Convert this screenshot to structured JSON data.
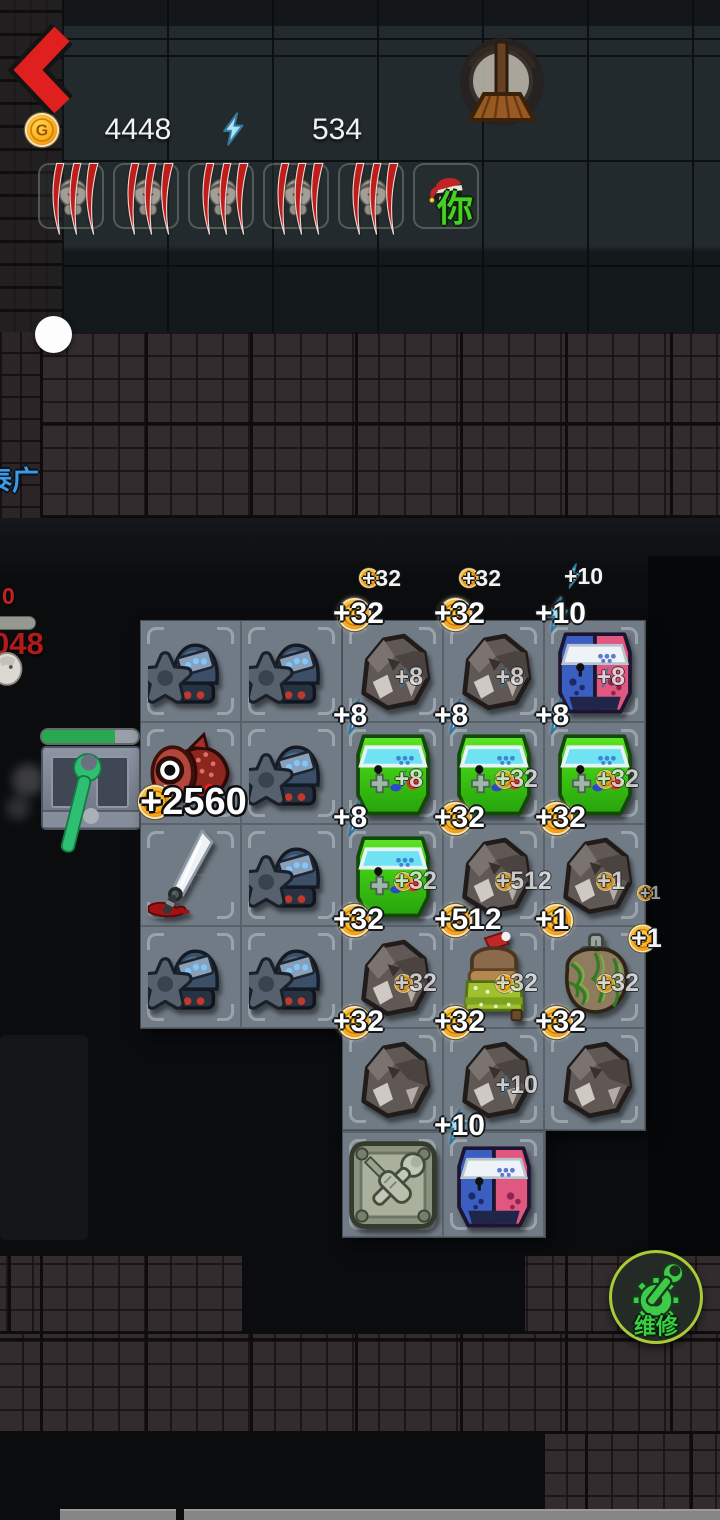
{
  "topbar": {
    "gold": "4448",
    "energy": "534"
  },
  "squad": {
    "you_label": "你",
    "slots": [
      {
        "state": "dead"
      },
      {
        "state": "dead"
      },
      {
        "state": "dead"
      },
      {
        "state": "dead"
      },
      {
        "state": "dead"
      },
      {
        "state": "you",
        "label": "你"
      }
    ]
  },
  "hud": {
    "player_name": "泰广",
    "dmg_small": "0",
    "dmg_big": "048"
  },
  "repair_station": {
    "progress": 0.76
  },
  "repair_button": {
    "label": "维修"
  },
  "icons": {
    "coin_letter": "G"
  },
  "popups": {
    "big_reward": {
      "icon": "coin",
      "text": "+2560"
    },
    "above_grid": [
      {
        "icon": "coin",
        "text": "+32"
      },
      {
        "icon": "coin",
        "text": "+32"
      },
      {
        "icon": "bolt",
        "text": "+10"
      }
    ],
    "side": [
      {
        "icon": "coin",
        "text": "+1",
        "size": "small"
      },
      {
        "icon": "coin",
        "text": "+1",
        "size": "large"
      }
    ]
  },
  "grid": {
    "cells": [
      {
        "r": 1,
        "c": 1,
        "item": "turret"
      },
      {
        "r": 1,
        "c": 2,
        "item": "turret"
      },
      {
        "r": 1,
        "c": 3,
        "item": "rock",
        "badge": {
          "icon": "coin",
          "text": "+32"
        },
        "sub": {
          "icon": "bolt",
          "text": "+8"
        }
      },
      {
        "r": 1,
        "c": 4,
        "item": "rock",
        "badge": {
          "icon": "coin",
          "text": "+32"
        },
        "sub": {
          "icon": "bolt",
          "text": "+8"
        }
      },
      {
        "r": 1,
        "c": 5,
        "item": "arcadePink",
        "badge": {
          "icon": "bolt",
          "text": "+10"
        },
        "sub": {
          "icon": "bolt",
          "text": "+8"
        }
      },
      {
        "r": 2,
        "c": 1,
        "item": "redfish"
      },
      {
        "r": 2,
        "c": 2,
        "item": "turret"
      },
      {
        "r": 2,
        "c": 3,
        "item": "arcadeGreen",
        "badge": {
          "icon": "bolt",
          "text": "+8"
        },
        "sub": {
          "icon": "bolt",
          "text": "+8"
        }
      },
      {
        "r": 2,
        "c": 4,
        "item": "arcadeGreen",
        "badge": {
          "icon": "bolt",
          "text": "+8"
        },
        "sub": {
          "icon": "coin",
          "text": "+32"
        }
      },
      {
        "r": 2,
        "c": 5,
        "item": "arcadeGreen",
        "badge": {
          "icon": "bolt",
          "text": "+8"
        },
        "sub": {
          "icon": "coin",
          "text": "+32"
        }
      },
      {
        "r": 3,
        "c": 1,
        "item": "knife"
      },
      {
        "r": 3,
        "c": 2,
        "item": "turret"
      },
      {
        "r": 3,
        "c": 3,
        "item": "arcadeGreen",
        "badge": {
          "icon": "bolt",
          "text": "+8"
        },
        "sub": {
          "icon": "coin",
          "text": "+32"
        }
      },
      {
        "r": 3,
        "c": 4,
        "item": "rock",
        "badge": {
          "icon": "coin",
          "text": "+32"
        },
        "sub": {
          "icon": "coin",
          "text": "+512"
        }
      },
      {
        "r": 3,
        "c": 5,
        "item": "rock",
        "badge": {
          "icon": "coin",
          "text": "+32"
        },
        "sub": {
          "icon": "coin",
          "text": "+1"
        }
      },
      {
        "r": 4,
        "c": 1,
        "item": "turret"
      },
      {
        "r": 4,
        "c": 2,
        "item": "turret"
      },
      {
        "r": 4,
        "c": 3,
        "item": "rock",
        "badge": {
          "icon": "coin",
          "text": "+32"
        },
        "sub": {
          "icon": "coin",
          "text": "+32"
        }
      },
      {
        "r": 4,
        "c": 4,
        "item": "bed",
        "badge": {
          "icon": "coin",
          "text": "+512"
        },
        "sub": {
          "icon": "coin",
          "text": "+32"
        }
      },
      {
        "r": 4,
        "c": 5,
        "item": "moss",
        "badge": {
          "icon": "coin",
          "text": "+1"
        },
        "sub": {
          "icon": "coin",
          "text": "+32"
        }
      },
      {
        "r": 5,
        "c": 3,
        "item": "rock",
        "badge": {
          "icon": "coin",
          "text": "+32"
        }
      },
      {
        "r": 5,
        "c": 4,
        "item": "rock",
        "badge": {
          "icon": "coin",
          "text": "+32"
        },
        "sub": {
          "icon": "bolt",
          "text": "+10"
        }
      },
      {
        "r": 5,
        "c": 5,
        "item": "rock",
        "badge": {
          "icon": "coin",
          "text": "+32"
        }
      },
      {
        "r": 6,
        "c": 3,
        "item": "toolbox"
      },
      {
        "r": 6,
        "c": 4,
        "item": "arcadePink",
        "badge": {
          "icon": "bolt",
          "text": "+10"
        }
      }
    ]
  }
}
